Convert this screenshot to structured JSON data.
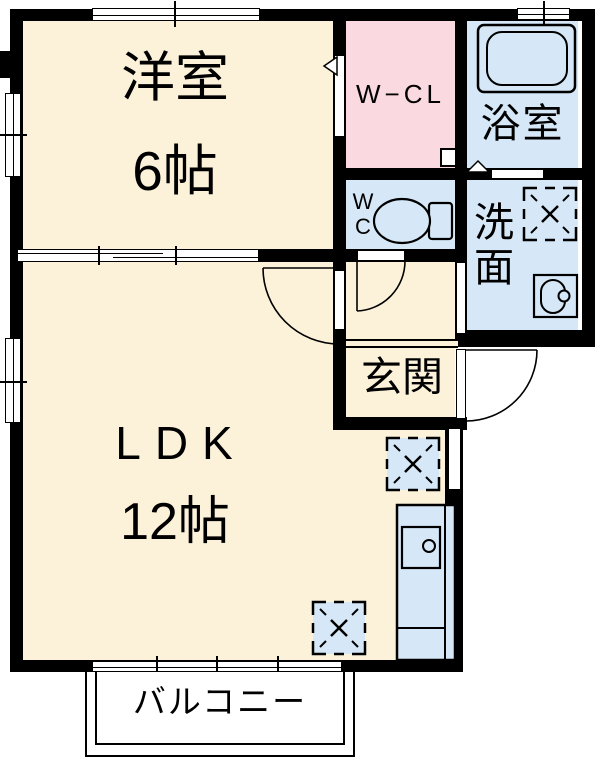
{
  "diagram_type": "apartment-floor-plan",
  "rooms": {
    "western_room": {
      "label": "洋室",
      "size": "6帖"
    },
    "walk_in_closet": {
      "label": "W−CL"
    },
    "bathroom": {
      "label": "浴室"
    },
    "toilet": {
      "line1": "W",
      "line2": "C"
    },
    "washroom": {
      "line1": "洗",
      "line2": "面"
    },
    "entrance": {
      "label": "玄関"
    },
    "ldk": {
      "label": "LDK",
      "size": "12帖"
    },
    "balcony": {
      "label": "バルコニー"
    }
  },
  "colors": {
    "room_cream": "#FCF2DA",
    "closet_pink": "#FAD9E0",
    "wet_area_blue": "#D6E8F7",
    "wall": "#000000",
    "background": "#FFFFFF"
  },
  "icons": [
    "bathtub-icon",
    "toilet-icon",
    "washing-machine-pan-icon",
    "appliance-space-icon",
    "kitchen-counter-icon",
    "kitchen-sink-icon",
    "vanity-sink-icon",
    "door-swing-arc",
    "folding-door-marker",
    "sliding-window"
  ]
}
